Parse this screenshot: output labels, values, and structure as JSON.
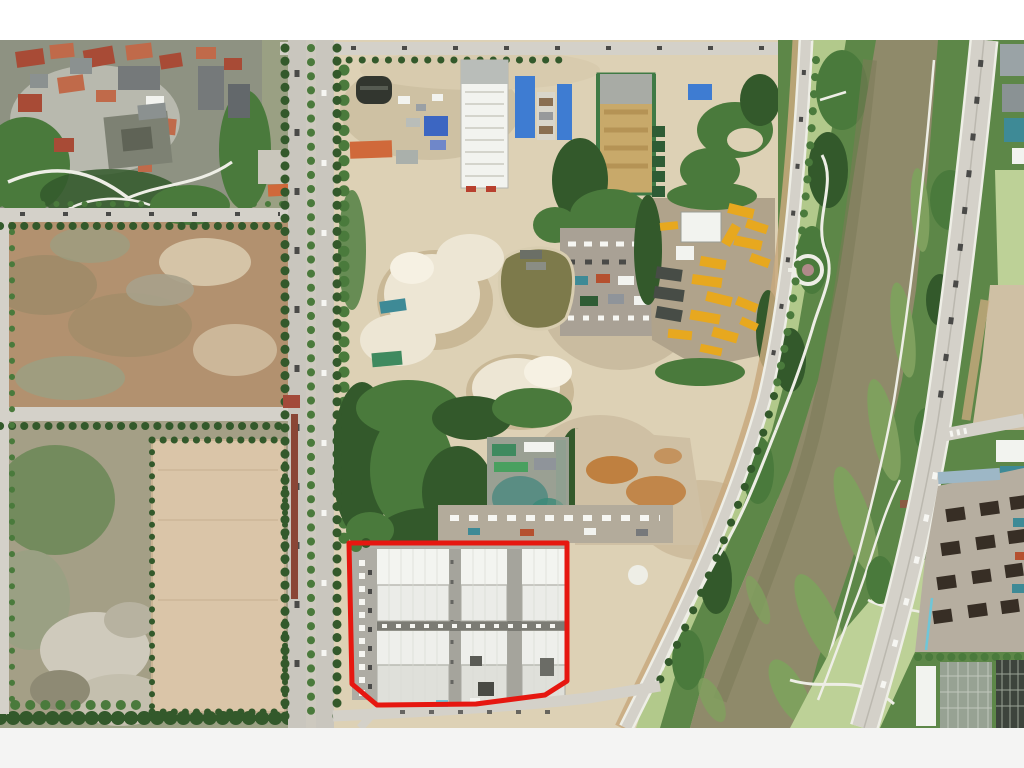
{
  "meta": {
    "title": "Aerial drone photograph of a riverside construction district; a warehouse complex parcel is outlined in red",
    "photo_area": {
      "top": 40,
      "bottom": 728,
      "left": 0,
      "right": 1024
    }
  },
  "annotation": {
    "name": "highlighted-parcel-outline",
    "shape": "polygon",
    "points": "349,543 567,543 567,681 545,695 476,704 377,705 352,684",
    "color": "#e61710",
    "stroke_width": 5,
    "encloses": "six white warehouse buildings in two rows of three with parking strip"
  },
  "regions": [
    "urban-village-top-left",
    "cleared-dirt-lots-left",
    "main-avenue-vertical",
    "construction-zone-center",
    "white-highrise-under-construction",
    "blue-roof-warehouses",
    "sand-stockpiles",
    "retention-pond",
    "yellow-equipment-yard",
    "scrapyard-greenhouses",
    "truck-staging-area",
    "warehouse-complex-highlighted",
    "levee-road",
    "riverside-park",
    "river-channel",
    "east-riverside-road",
    "construction-site-bottom-right",
    "urban-blocks-top-right"
  ],
  "palette": {
    "margin-top": "#ffffff",
    "margin-bottom": "#f4f4f3",
    "dirt-base": "#cfc0a4",
    "dirt-brown": "#b2916f",
    "dirt-dark": "#9c8a68",
    "dirt-light": "#ddd1b5",
    "dirt-pink": "#dac5a8",
    "scrub": "#9aa083",
    "sand-pile": "#ede6d4",
    "sand-shadow": "#c9b896",
    "pond": "#7d7a4b",
    "mud-orange": "#bf8040",
    "road": "#d4d1c9",
    "road-main": "#c9c6be",
    "tree-dark": "#33592b",
    "tree-mid": "#4a7a3c",
    "tree-light": "#68975a",
    "grass-park": "#b2c98b",
    "grass-field": "#bdd197",
    "bank-veg": "#5d8748",
    "water": "#8f8a6a",
    "water-dark": "#7c7a58",
    "reed-green": "#7fa05e",
    "path-white": "#eeeee6",
    "urban-base": "#8e9282",
    "roof-red": "#a84b36",
    "roof-red2": "#c06a4a",
    "roof-gray": "#8b9190",
    "bldg-gray": "#75797a",
    "white-bldg": "#f2f3ef",
    "blue-roof": "#3e7cd2",
    "blue-tarp": "#3c66c2",
    "green-net": "#3f7a45",
    "constr-tan": "#c8a express96a",
    "yellow-equip": "#e7a81f",
    "dark-equip": "#474c46",
    "truck-green": "#2f5c35",
    "concrete": "#b3b1a8",
    "wh-roof": "#ebece8",
    "wh-roof-dim": "#dfe0da",
    "wh-line": "#b9bab2",
    "frame-dark": "#372e25",
    "teal-roof": "#3e8a96",
    "red-annotation": "#e61710",
    "red-wall": "#8a4636",
    "orange-roof": "#d0693a",
    "grid-bldg-dark": "#3d443c",
    "grid-bldg-light": "#97a293"
  }
}
